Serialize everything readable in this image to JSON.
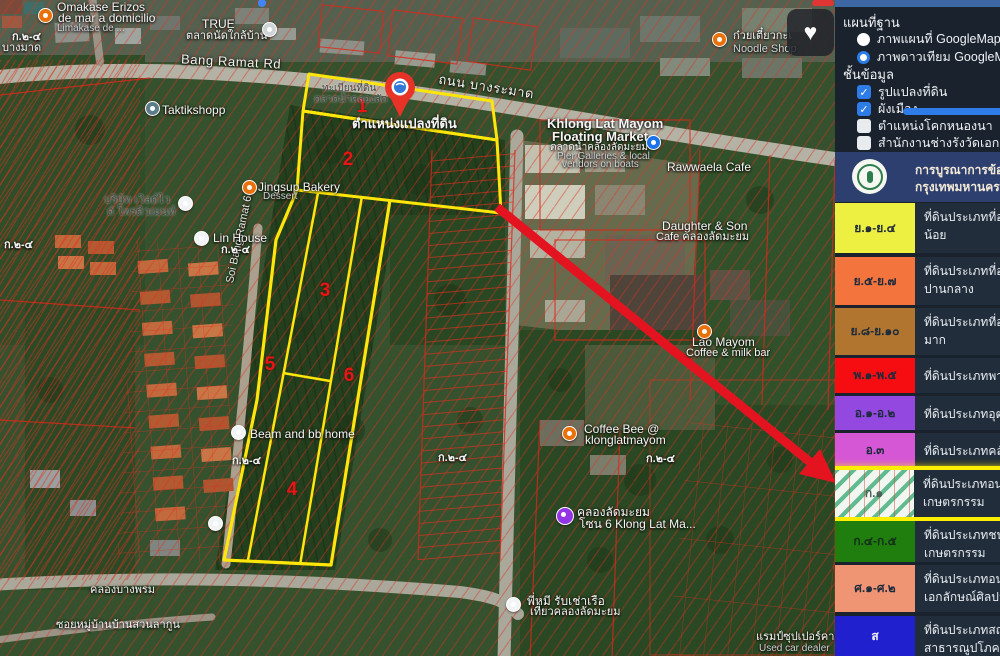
{
  "panel": {
    "base_map_title": "แผนที่ฐาน",
    "base_map_options": [
      {
        "label": "ภาพแผนที่ GoogleMap",
        "selected": false
      },
      {
        "label": "ภาพดาวเทียม GoogleMap",
        "selected": true
      }
    ],
    "layers_title": "ชั้นข้อมูล",
    "layers": [
      {
        "label": "รูปแปลงที่ดิน",
        "checked": true
      },
      {
        "label": "ผังเมือง",
        "checked": true
      },
      {
        "label": "ตำแหน่งโคกหนองนา",
        "checked": false
      },
      {
        "label": "สำนักงานช่างรังวัดเอกชน",
        "checked": false
      }
    ],
    "check_glyph": "✓",
    "banner": {
      "line1": "การบูรณาการข้อมูล",
      "line2": "กรุงเทพมหานคร"
    },
    "legend": [
      {
        "code": "ย.๑-ย.๔",
        "color": "#eef041",
        "desc1": "ที่ดินประเภทที่อยู่อาศัยหนาแน่น",
        "desc2": "น้อย"
      },
      {
        "code": "ย.๕-ย.๗",
        "color": "#f4743e",
        "desc1": "ที่ดินประเภทที่อยู่อาศัยหนาแน่น",
        "desc2": "ปานกลาง"
      },
      {
        "code": "ย.๘-ย.๑๐",
        "color": "#b1752f",
        "desc1": "ที่ดินประเภทที่อยู่อาศัยหนาแน่น",
        "desc2": "มาก"
      },
      {
        "code": "พ.๑-พ.๕",
        "color": "#f50d12",
        "desc1": "ที่ดินประเภทพาณิชยกรรม",
        "desc2": ""
      },
      {
        "code": "อ.๑-อ.๒",
        "color": "#9348e0",
        "desc1": "ที่ดินประเภทอุตสาหกรรม",
        "desc2": ""
      },
      {
        "code": "อ.๓",
        "color": "#d657d6",
        "desc1": "ที่ดินประเภทคลังสินค้า",
        "desc2": ""
      },
      {
        "code": "ก.๑",
        "color": "striped",
        "highlighted": true,
        "desc1": "ที่ดินประเภทอนุรักษ์ชนบทและ",
        "desc2": "เกษตรกรรม"
      },
      {
        "code": "ก.๔-ก.๕",
        "color": "#1f7e0d",
        "desc1": "ที่ดินประเภทชนบทและ",
        "desc2": "เกษตรกรรม"
      },
      {
        "code": "ศ.๑-ศ.๒",
        "color": "#f09574",
        "desc1": "ที่ดินประเภทอนุรักษ์เพื่อส่งเสริม",
        "desc2": "เอกลักษณ์ศิลปวัฒนธรรมไทย"
      },
      {
        "code": "ส",
        "color": "#2020cf",
        "desc1": "ที่ดินประเภทสถาบันราชการ การ",
        "desc2": "สาธารณูปโภคและสาธารณูปการ"
      }
    ],
    "highlight_color": "#ffee00"
  },
  "map": {
    "pin_label": "ตำแหน่งแปลงที่ดิน",
    "zone_label": "ก.๒-๔",
    "parcel_numbers": [
      "1",
      "2",
      "3",
      "4",
      "5",
      "6"
    ],
    "parcel_outline_color": "#ffe60a",
    "cadastral_line_color": "#e0321e",
    "arrow_color": "#e31420",
    "heart_glyph": "♥",
    "roads": {
      "bang_ramat_en": "Bang Ramat Rd",
      "bang_ramat_th": "ถนน บางระมาด",
      "soi_bang_ramat": "Soi Bang Ramat 6",
      "soi_lagoon": "ซอยหมู่บ้านบ้านสวนลากูน",
      "khlong_bang_phrom": "คลองบางพรม",
      "bang_mat": "บางมาด"
    },
    "pois": {
      "omakase1": "Omakase Erizos",
      "omakase2": "de mar a domicilio",
      "omakase3": "Limakase de ...",
      "true1": "TRUE",
      "true2": "ตลาดนัดใกล้บ้าน",
      "taktik": "Taktikshopp",
      "noodle1": "ก๋วยเตี๋ยวกะเ",
      "noodle2": "Noodle Shop",
      "regis1": "ทะเบียนที่ดิน",
      "regis2": "ตลาดน้ำคลองลัด",
      "khlong1": "Khlong Lat Mayom",
      "khlong2": "Floating Market",
      "khlong3": "ตลาดน้ำคลองลัดมะยม",
      "khlong4": "Pier Galleries & local",
      "khlong5": "vendors on boats",
      "rawwaela": "Rawwaela Cafe",
      "daughter1": "Daughter & Son",
      "daughter2": "Cafe คลองลัดมะยม",
      "jingsup1": "Jingsup Bakery",
      "jingsup2": "Dessert",
      "company1": "บริษัท เวิลด์ไว",
      "company2": "ด์ โพรดิวเมนท์",
      "linhouse": "Lin House",
      "lao1": "Lao Mayom",
      "lao2": "Coffee & milk bar",
      "beam": "Beam and bb home",
      "coffeebee1": "Coffee Bee @",
      "coffeebee2": "klonglatmayom",
      "klz1": "คลองลัดมะยม",
      "klz2": "โซน 6 Klong Lat Ma...",
      "pmee1": "พี่หมี รับเช่าเรือ",
      "pmee2": "เที่ยวคลองลัดมะยม",
      "ramp1": "แรมป์ซุปเปอร์คาร์",
      "ramp2": "Used car dealer"
    }
  }
}
